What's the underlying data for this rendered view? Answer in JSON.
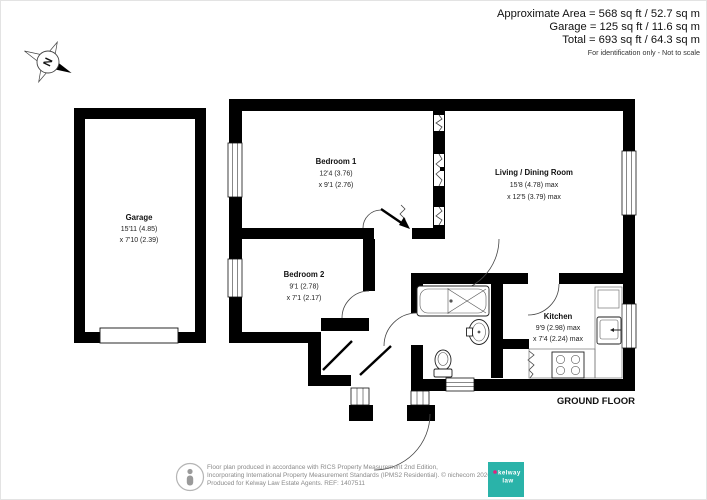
{
  "header": {
    "lines": [
      "Approximate Area = 568 sq ft / 52.7 sq m",
      "Garage = 125 sq ft / 11.6 sq m",
      "Total = 693 sq ft / 64.3 sq m"
    ],
    "disclaimer": "For identification only - Not to scale"
  },
  "compass": {
    "north": "N"
  },
  "rooms": [
    {
      "name": "Garage",
      "dim1": "15'11 (4.85)",
      "dim2": "x 7'10 (2.39)"
    },
    {
      "name": "Bedroom 1",
      "dim1": "12'4 (3.76)",
      "dim2": "x 9'1 (2.76)"
    },
    {
      "name": "Living / Dining Room",
      "dim1": "15'8 (4.78) max",
      "dim2": "x 12'5 (3.79) max"
    },
    {
      "name": "Bedroom 2",
      "dim1": "9'1 (2.78)",
      "dim2": "x 7'1 (2.17)"
    },
    {
      "name": "Kitchen",
      "dim1": "9'9 (2.98) max",
      "dim2": "x 7'4 (2.24) max"
    }
  ],
  "floor_label": "GROUND FLOOR",
  "footer": {
    "lines": [
      "Floor plan produced in accordance with RICS Property Measurement 2nd Edition,",
      "Incorporating International Property Measurement Standards (IPMS2 Residential).  © nichecom 2026.",
      "Produced for Kelway Law Estate Agents.   REF:  1407511"
    ],
    "logo": {
      "word1": "kelway",
      "word2": "law"
    }
  },
  "colors": {
    "wall": "#000000",
    "logo_teal": "#2ab3a9",
    "logo_pink": "#e51f7f"
  }
}
